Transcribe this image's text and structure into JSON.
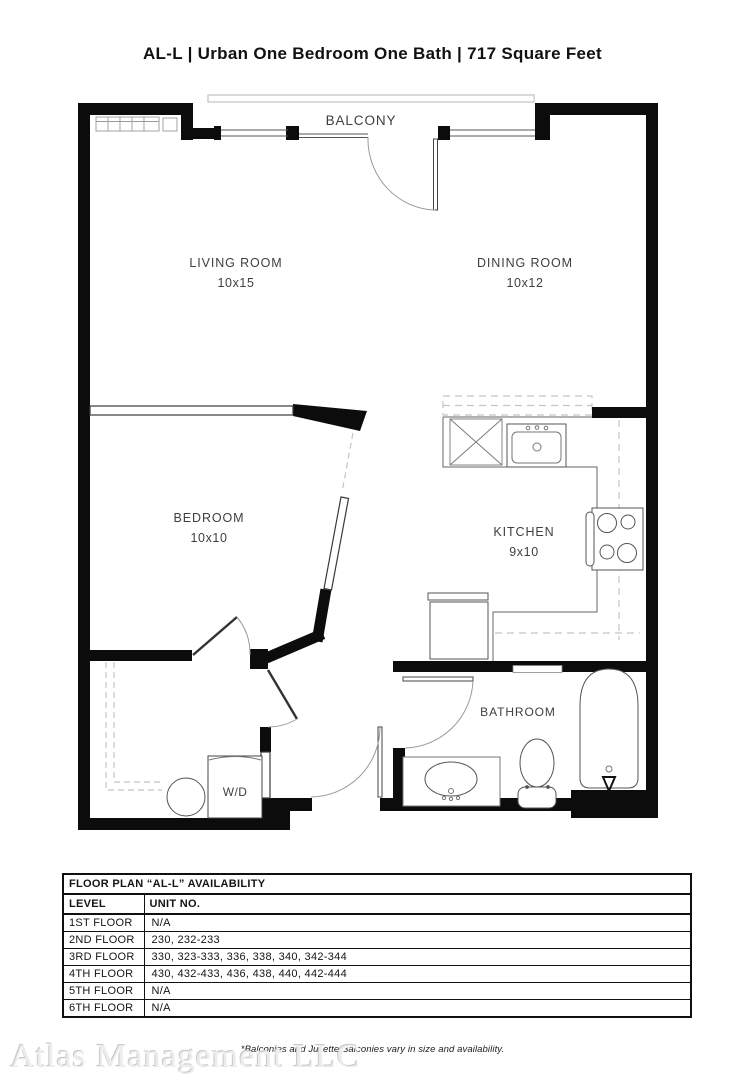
{
  "header": {
    "title": "AL-L | Urban One Bedroom One Bath | 717  Square Feet"
  },
  "plan": {
    "balcony_label": "BALCONY",
    "rooms": {
      "living": {
        "name": "LIVING ROOM",
        "dims": "10x15"
      },
      "dining": {
        "name": "DINING ROOM",
        "dims": "10x12"
      },
      "bedroom": {
        "name": "BEDROOM",
        "dims": "10x10"
      },
      "kitchen": {
        "name": "KITCHEN",
        "dims": "9x10"
      },
      "bathroom": {
        "name": "BATHROOM"
      },
      "laundry": {
        "name": "W/D"
      }
    }
  },
  "availability_table": {
    "title": "FLOOR PLAN “AL-L” AVAILABILITY",
    "columns": [
      "LEVEL",
      "UNIT NO."
    ],
    "rows": [
      {
        "level": "1ST FLOOR",
        "units": "N/A"
      },
      {
        "level": "2ND FLOOR",
        "units": "230, 232-233"
      },
      {
        "level": "3RD FLOOR",
        "units": "330, 323-333, 336, 338, 340, 342-344"
      },
      {
        "level": "4TH FLOOR",
        "units": "430, 432-433, 436, 438, 440, 442-444"
      },
      {
        "level": "5TH FLOOR",
        "units": "N/A"
      },
      {
        "level": "6TH FLOOR",
        "units": "N/A"
      }
    ]
  },
  "footnote": "*Balconies and Juliette Balconies vary in size and availability.",
  "watermark": "Atlas Management LLC",
  "colors": {
    "wall": "#0c0c0c",
    "fixture_line": "#555555",
    "dash_line": "#c4c4c4",
    "arc_line": "#9a9a9a"
  }
}
